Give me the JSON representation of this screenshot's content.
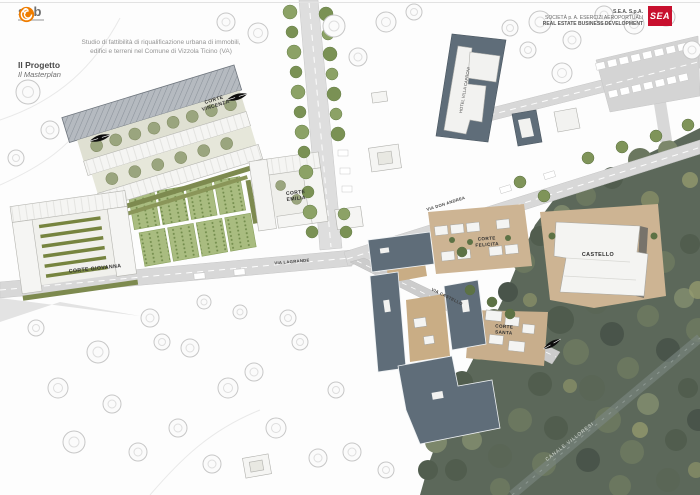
{
  "header": {
    "sab_logo_text": "sab",
    "sea_lines": {
      "l1": "S.E.A. S.p.A.",
      "l2": "SOCIETÀ p. A. ESERCIZI AEROPORTUALI",
      "l3": "REAL ESTATE BUSINESS DEVELOPMENT"
    },
    "sea_logo": "SEA"
  },
  "title": {
    "subtitle_line1": "Studio di fattibilità di riqualificazione urbana di immobili,",
    "subtitle_line2": "edifici e terreni nel Comune di Vizzola Ticino (VA)",
    "section": "Il Progetto",
    "section_sub": "Il Masterplan"
  },
  "map": {
    "labels": {
      "corte_vincenza": [
        "CORTE",
        "VINCENZA"
      ],
      "corte_giovanna": "CORTE GIOVANNA",
      "corte_emilia": [
        "CORTE",
        "EMILIA"
      ],
      "corte_felicita": [
        "CORTE",
        "FELICITA"
      ],
      "castello": "CASTELLO",
      "corte_santa": [
        "CORTE",
        "SANTA"
      ],
      "hotel": "HOTEL VILLA CAPRONI",
      "canale": "CANALE VILLORESI"
    },
    "streets": {
      "via_lagrande": "VIA LAGRANDE",
      "via_don_andrea": "VIA DON ANDREA",
      "via_castello": "VIA CASTELLO"
    },
    "colors": {
      "forest": "#5c685a",
      "road": "#d8d8d8",
      "building_new_dark": "#5f6d79",
      "building_white": "#f4f4f2",
      "orchard_green": "#a9bc80",
      "ground_tan": "#cdb493",
      "sea_red": "#c8102e",
      "sab_orange": "#ef7d00"
    }
  }
}
